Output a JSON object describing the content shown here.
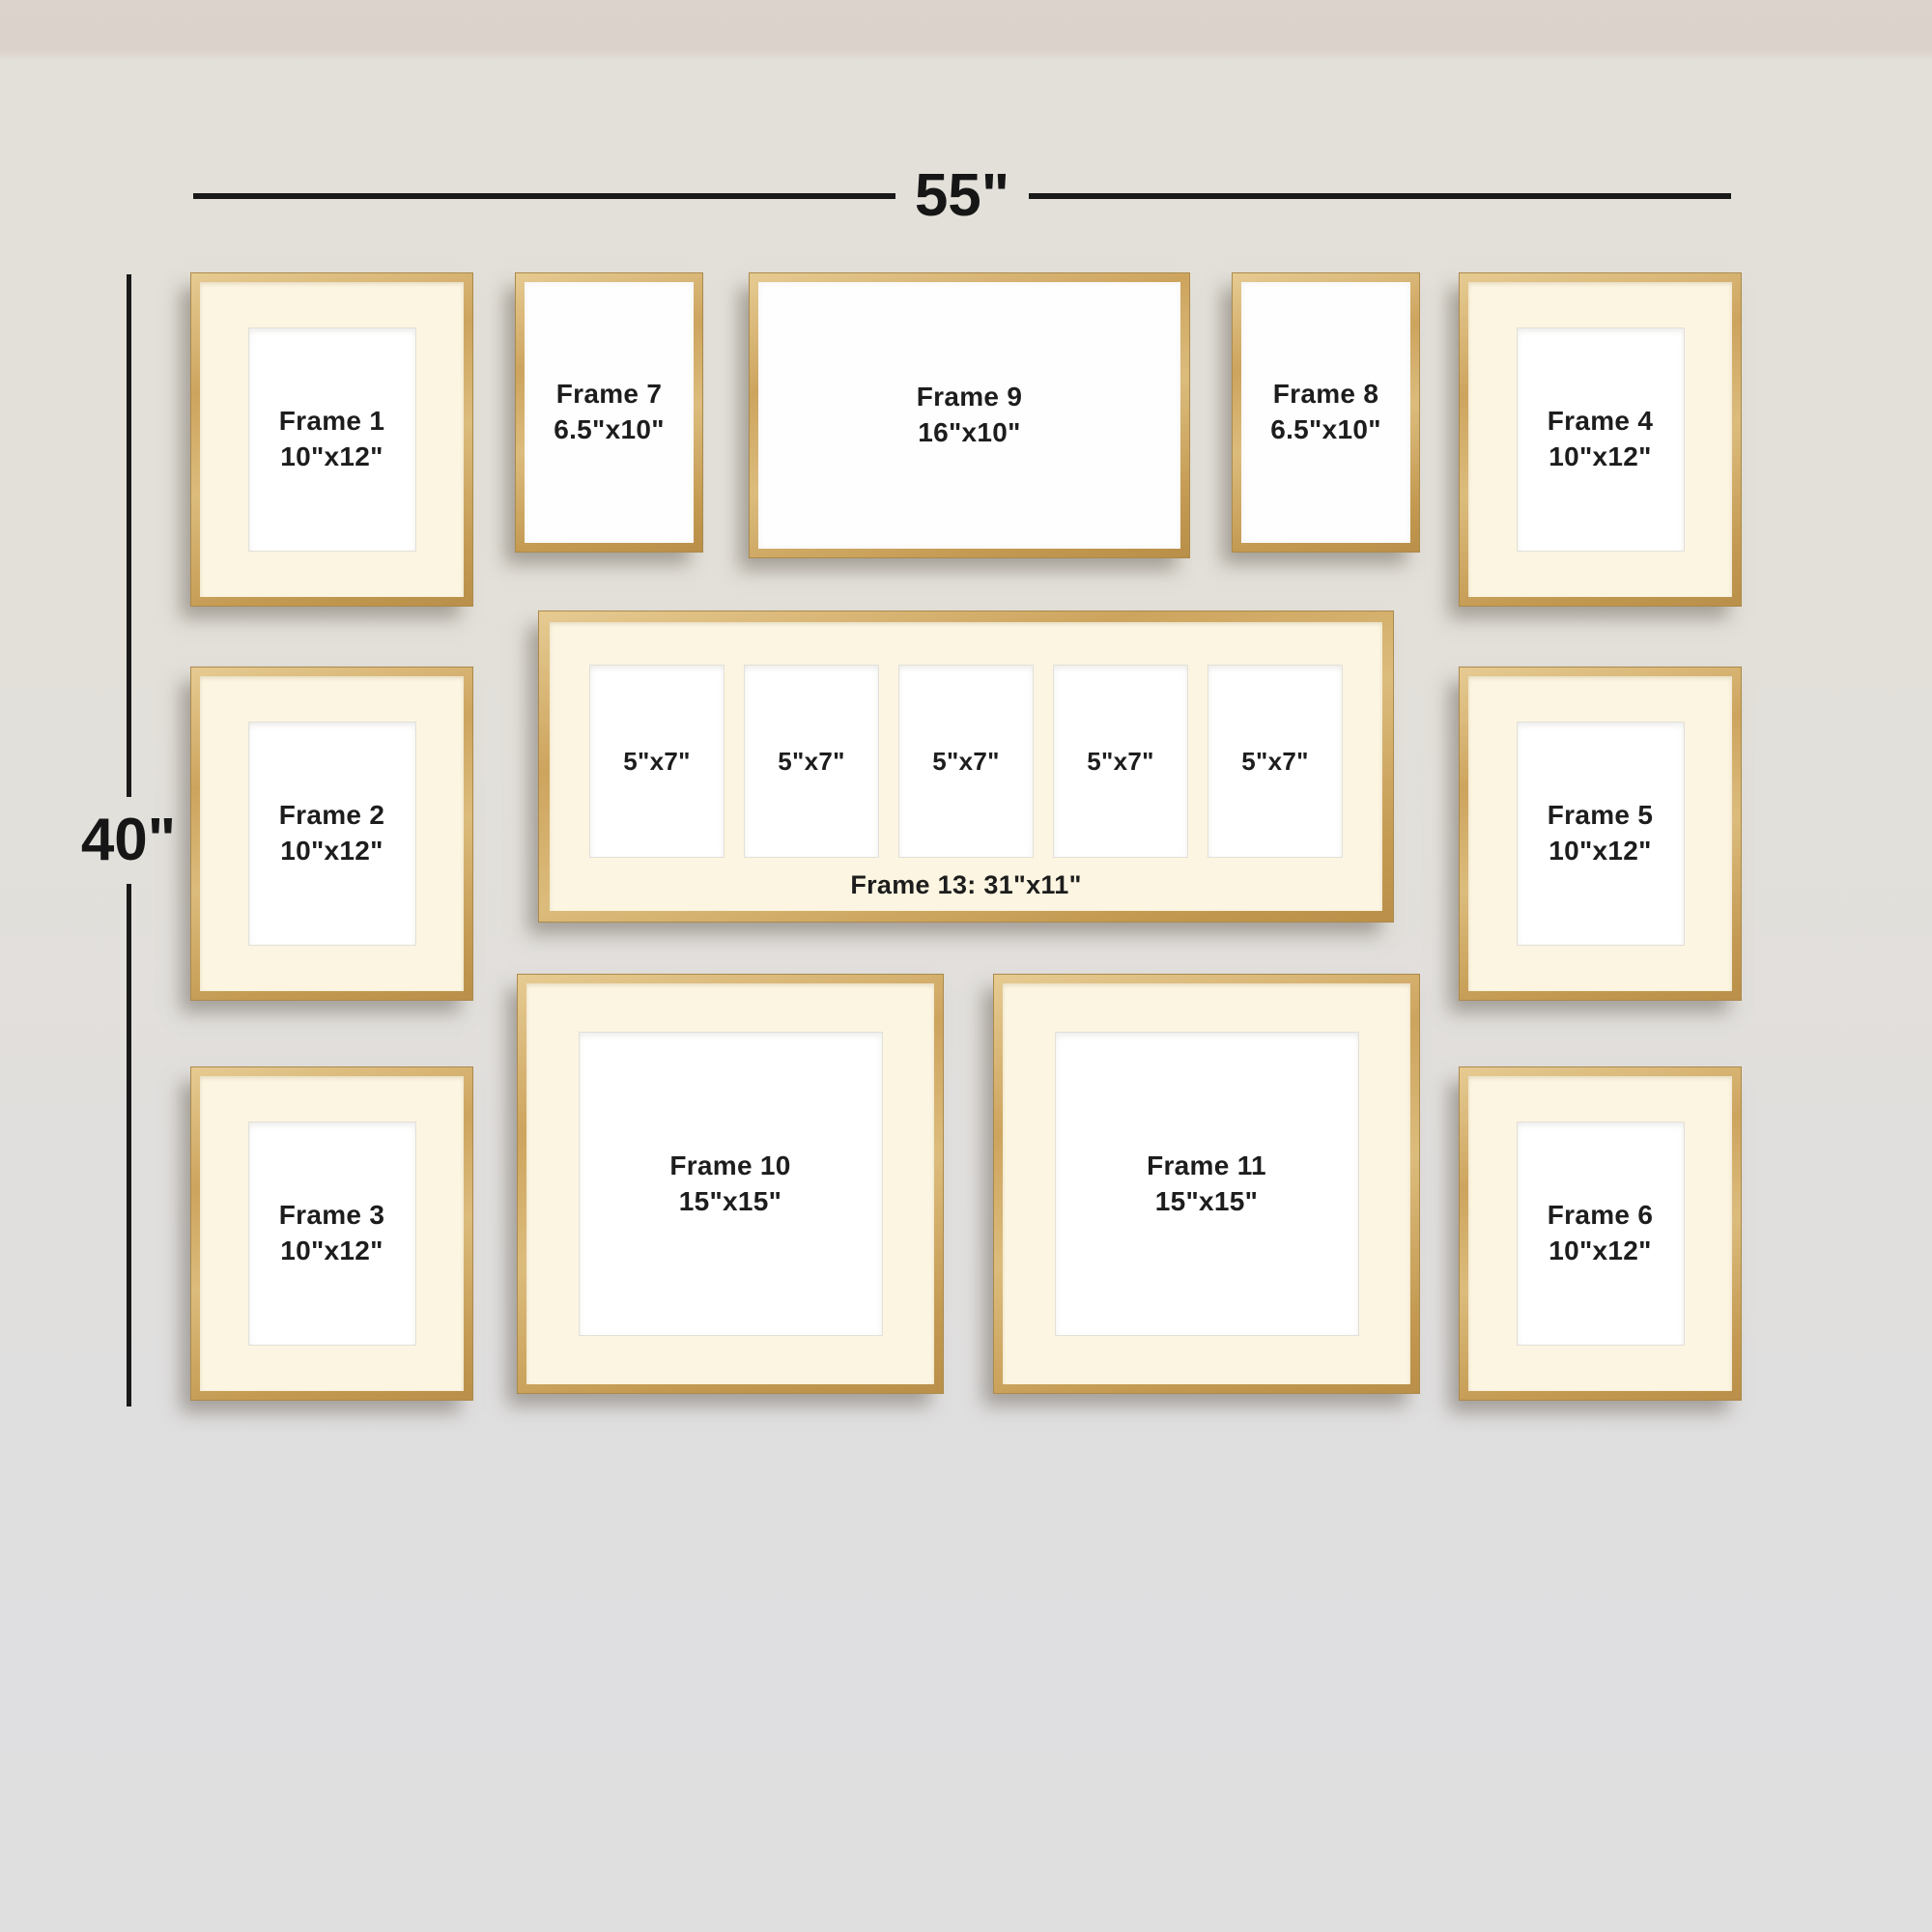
{
  "dimensions": {
    "width_label": "55\"",
    "height_label": "40\""
  },
  "frames": {
    "f1": {
      "name": "Frame 1",
      "size": "10\"x12\""
    },
    "f2": {
      "name": "Frame 2",
      "size": "10\"x12\""
    },
    "f3": {
      "name": "Frame 3",
      "size": "10\"x12\""
    },
    "f4": {
      "name": "Frame 4",
      "size": "10\"x12\""
    },
    "f5": {
      "name": "Frame 5",
      "size": "10\"x12\""
    },
    "f6": {
      "name": "Frame 6",
      "size": "10\"x12\""
    },
    "f7": {
      "name": "Frame 7",
      "size": "6.5\"x10\""
    },
    "f8": {
      "name": "Frame 8",
      "size": "6.5\"x10\""
    },
    "f9": {
      "name": "Frame 9",
      "size": "16\"x10\""
    },
    "f10": {
      "name": "Frame 10",
      "size": "15\"x15\""
    },
    "f11": {
      "name": "Frame 11",
      "size": "15\"x15\""
    },
    "f13": {
      "caption": "Frame 13: 31\"x11\"",
      "opening_size": "5\"x7\"",
      "openings_count": 5
    }
  },
  "colors": {
    "frame_gold": "#cda45e",
    "mat_cream": "#fcf5e1",
    "opening_white": "#ffffff",
    "wall_top": "#ddd3cd",
    "wall_main": "#e2dfd9",
    "text": "#1d1d1d",
    "dimension_line": "#191919"
  }
}
